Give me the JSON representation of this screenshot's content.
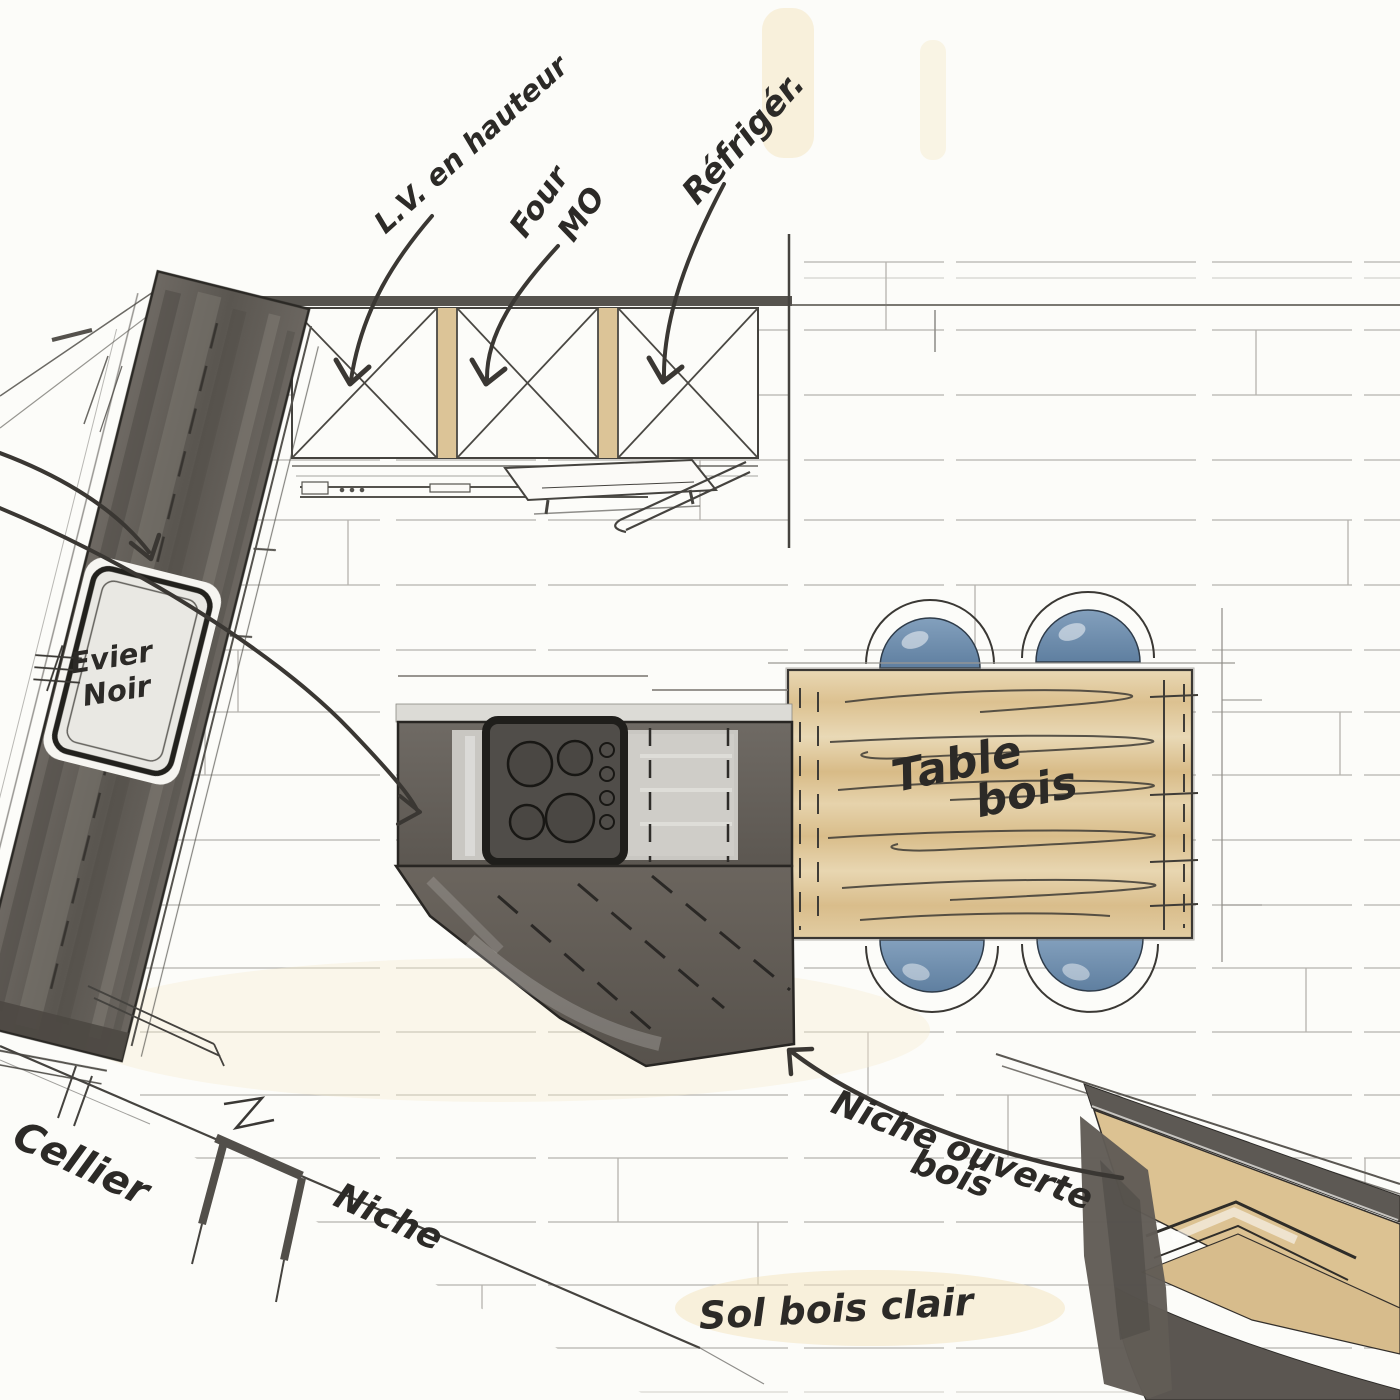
{
  "meta": {
    "title": "Croquis plan de cuisine — esquisse au feutre",
    "type": "hand-drawn kitchen floor plan sketch"
  },
  "palette": {
    "paper": "#fcfcf9",
    "marker_dark": "#5f5a55",
    "ink": "#2d2b28",
    "wood": "#dcc292",
    "chair_blue": "#6d89a8",
    "floor_line": "#a3a09a",
    "tint_cream": "#f3e4bd"
  },
  "annotations": {
    "dishwasher_label": "L.V. en hauteur",
    "oven_label": "Four",
    "microwave_label": "MO",
    "fridge_label": "Réfrigér.",
    "sink_label_line1": "Evier",
    "sink_label_line2": "Noir",
    "table_label_line1": "Table",
    "table_label_line2": "bois",
    "open_niche_label_line1": "Niche ouverte",
    "open_niche_label_line2": "bois",
    "floor_label": "Sol bois clair",
    "pantry_label": "Cellier",
    "wall_niche_label": "Niche"
  },
  "features": {
    "dining_chairs_count": 4,
    "cooktop_burners_count": 4,
    "tall_cabinets_count": 3
  }
}
